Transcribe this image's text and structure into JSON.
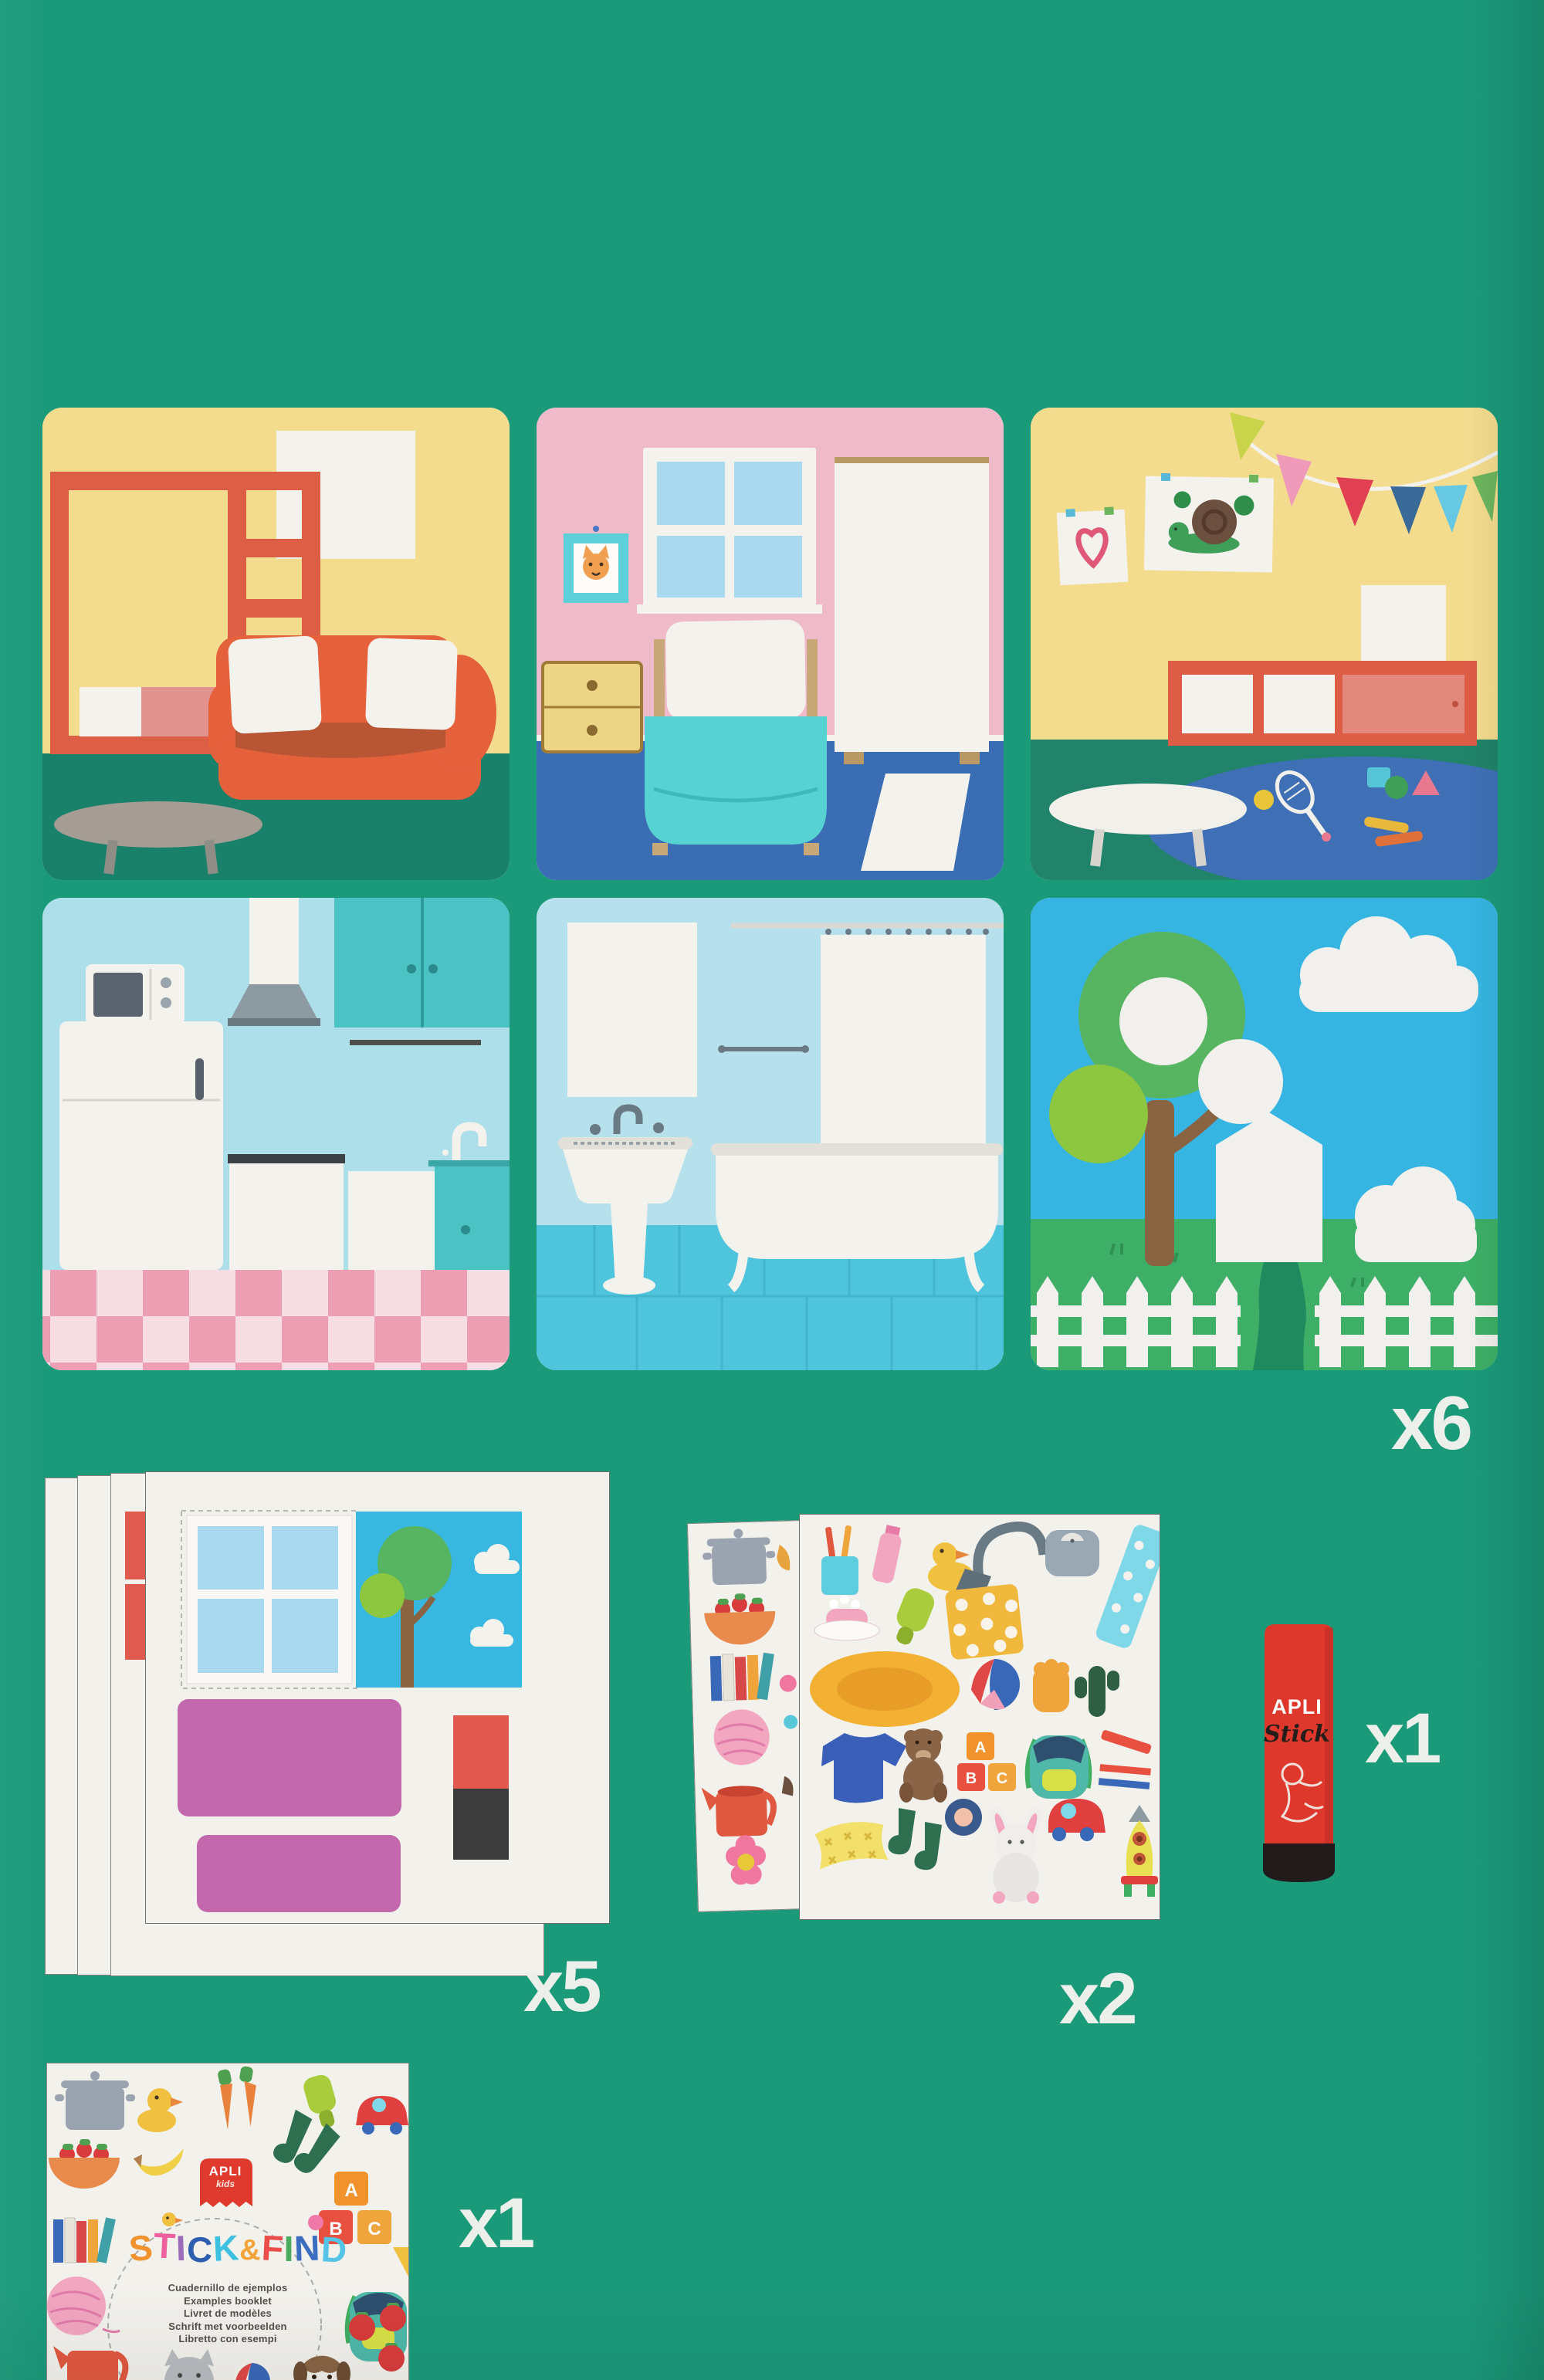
{
  "colors": {
    "background": "#1b9a7a",
    "apli_red": "#e0392e",
    "sheet_white": "#f2f1ec",
    "count_label": "#edf0ea"
  },
  "counts": {
    "scene_cards": "x6",
    "house_sheets": "x5",
    "sticker_sheets": "x2",
    "glue_stick": "x1",
    "booklet": "x1"
  },
  "cards": [
    {
      "name": "living-room"
    },
    {
      "name": "bedroom"
    },
    {
      "name": "playroom"
    },
    {
      "name": "kitchen"
    },
    {
      "name": "bathroom"
    },
    {
      "name": "garden"
    }
  ],
  "sticker_sheet": {
    "blocks": [
      "A",
      "B",
      "C"
    ]
  },
  "glue_stick": {
    "brand": "APLI",
    "product": "Stick"
  },
  "booklet": {
    "logo": {
      "brand": "APLI",
      "sub": "kids"
    },
    "blocks": [
      "A",
      "B",
      "C"
    ],
    "title": [
      {
        "ch": "S",
        "style": "color:#f0922e"
      },
      {
        "ch": "T",
        "style": "color:#ed5f9d"
      },
      {
        "ch": "I",
        "style": "color:#9a6cba"
      },
      {
        "ch": "C",
        "style": "color:#2d5fae"
      },
      {
        "ch": "K",
        "style": "color:#3ec1e0"
      },
      {
        "ch": "&",
        "style": "color:#f2a43b;font-size:38px"
      },
      {
        "ch": "F",
        "style": "color:#ea4d4a"
      },
      {
        "ch": "I",
        "style": "color:#4cab5e"
      },
      {
        "ch": "N",
        "style": "color:#3b6ec0"
      },
      {
        "ch": "D",
        "style": "color:#55c4e6"
      }
    ],
    "subtitle_lines": [
      "Cuadernillo de ejemplos",
      "Examples booklet",
      "Livret de modèles",
      "Schrift met voorbeelden",
      "Libretto con esempi"
    ]
  }
}
